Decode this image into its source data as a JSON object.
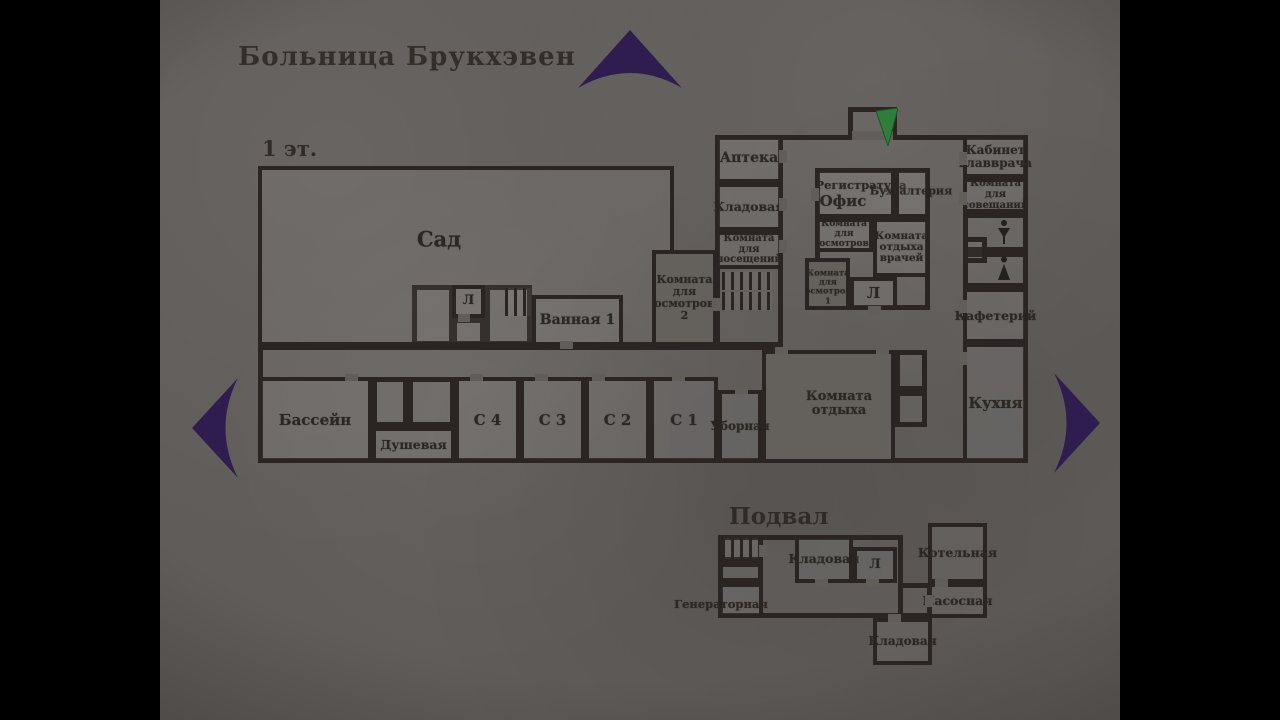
{
  "title": "Больница Брукхэвен",
  "colors": {
    "arrow_purple": "#301d4f",
    "arrow_green": "#2e7d3a",
    "wall": "#2a2522",
    "ink": "#2b2723",
    "paper": "#605c59"
  },
  "floor1": {
    "label": "1 эт.",
    "rooms": [
      {
        "name": "garden",
        "label": "Сад",
        "x": 258,
        "y": 166,
        "w": 416,
        "h": 180,
        "fs": 21,
        "lx": 435,
        "ly": 236
      },
      {
        "name": "elevator-1",
        "label": "Л",
        "x": 452,
        "y": 285,
        "w": 33,
        "h": 33,
        "fs": 13
      },
      {
        "name": "bathroom-1",
        "label": "Ванная 1",
        "x": 532,
        "y": 295,
        "w": 91,
        "h": 51,
        "fs": 14,
        "nw": true
      },
      {
        "name": "exam-room-2",
        "label": "Комната\nдля\nосмотров\n2",
        "x": 652,
        "y": 250,
        "w": 65,
        "h": 96,
        "fs": 11,
        "solid": true
      },
      {
        "name": "pharmacy",
        "label": "Аптека",
        "x": 715,
        "y": 135,
        "w": 68,
        "h": 48,
        "fs": 14
      },
      {
        "name": "storeroom-1f",
        "label": "Кладовая",
        "x": 715,
        "y": 183,
        "w": 68,
        "h": 48,
        "fs": 12.5
      },
      {
        "name": "visiting-room",
        "label": "Комната для\nпосещений",
        "x": 715,
        "y": 231,
        "w": 68,
        "h": 38,
        "fs": 10
      },
      {
        "name": "registration-office",
        "label": "Регистратура",
        "x": 815,
        "y": 168,
        "w": 80,
        "h": 50,
        "fs": 11.5,
        "lx": 857,
        "ly": 181
      },
      {
        "name": "accounting",
        "label": "",
        "x": 895,
        "y": 168,
        "w": 35,
        "h": 50,
        "fs": 11
      },
      {
        "name": "exam-room-mid",
        "label": "Комната\nдля\nосмотров",
        "x": 815,
        "y": 218,
        "w": 58,
        "h": 34,
        "fs": 9
      },
      {
        "name": "doctors-lounge",
        "label": "Комната\nотдыха\nврачей",
        "x": 873,
        "y": 218,
        "w": 57,
        "h": 59,
        "fs": 10.5
      },
      {
        "name": "exam-room-1",
        "label": "Комната\nдля\nосмотров\n1",
        "x": 805,
        "y": 258,
        "w": 45,
        "h": 52,
        "fs": 8.5,
        "lx": 824,
        "ly": 284,
        "solid": true
      },
      {
        "name": "elevator-2",
        "label": "Л",
        "x": 850,
        "y": 277,
        "w": 47,
        "h": 33,
        "fs": 15
      },
      {
        "name": "head-doctor-office",
        "label": "Кабинет\nглавврача",
        "x": 963,
        "y": 135,
        "w": 65,
        "h": 43,
        "fs": 12
      },
      {
        "name": "meeting-room",
        "label": "Комната для\nсовещаний",
        "x": 963,
        "y": 178,
        "w": 65,
        "h": 35,
        "fs": 10
      },
      {
        "name": "cafeteria",
        "label": "Кафетерий",
        "x": 963,
        "y": 288,
        "w": 65,
        "h": 55,
        "fs": 12.5,
        "nw": true
      },
      {
        "name": "kitchen",
        "label": "Кухня",
        "x": 963,
        "y": 343,
        "w": 65,
        "h": 120,
        "fs": 15
      },
      {
        "name": "lounge",
        "label": "Комната\nотдыха",
        "x": 762,
        "y": 350,
        "w": 133,
        "h": 113,
        "fs": 13,
        "lx": 835,
        "ly": 400,
        "solid": true
      },
      {
        "name": "pool",
        "label": "Бассейн",
        "x": 258,
        "y": 377,
        "w": 114,
        "h": 86,
        "fs": 15
      },
      {
        "name": "shower",
        "label": "Душевая",
        "x": 372,
        "y": 427,
        "w": 83,
        "h": 36,
        "fs": 12.5,
        "nw": true
      },
      {
        "name": "ward-c4",
        "label": "С 4",
        "x": 455,
        "y": 377,
        "w": 65,
        "h": 86,
        "fs": 15
      },
      {
        "name": "ward-c3",
        "label": "С 3",
        "x": 520,
        "y": 377,
        "w": 65,
        "h": 86,
        "fs": 15
      },
      {
        "name": "ward-c2",
        "label": "С 2",
        "x": 585,
        "y": 377,
        "w": 65,
        "h": 86,
        "fs": 15
      },
      {
        "name": "ward-c1",
        "label": "С 1",
        "x": 650,
        "y": 377,
        "w": 68,
        "h": 86,
        "fs": 15
      },
      {
        "name": "restroom",
        "label": "Уборная",
        "x": 718,
        "y": 390,
        "w": 44,
        "h": 73,
        "fs": 12,
        "nw": true
      }
    ],
    "blocks": [
      {
        "name": "south-strip",
        "x": 258,
        "y": 345,
        "w": 525,
        "h": 118,
        "noR": true
      },
      {
        "name": "north-wing",
        "x": 783,
        "y": 135,
        "w": 245,
        "h": 328,
        "noL": true
      },
      {
        "name": "west-column",
        "x": 715,
        "y": 135,
        "w": 68,
        "h": 212
      },
      {
        "name": "entrance-alcove",
        "x": 848,
        "y": 107,
        "w": 49,
        "h": 30
      },
      {
        "name": "room-by-lift",
        "x": 412,
        "y": 285,
        "w": 42,
        "h": 61
      },
      {
        "name": "lift-vestibule",
        "x": 452,
        "y": 318,
        "w": 33,
        "h": 28
      },
      {
        "name": "stairwell-garden",
        "x": 485,
        "y": 285,
        "w": 47,
        "h": 61
      },
      {
        "name": "central-island",
        "x": 815,
        "y": 168,
        "w": 115,
        "h": 142
      },
      {
        "name": "wc-room-1",
        "x": 963,
        "y": 213,
        "w": 65,
        "h": 39
      },
      {
        "name": "wc-room-2",
        "x": 963,
        "y": 252,
        "w": 65,
        "h": 36
      },
      {
        "name": "wc-niche",
        "x": 963,
        "y": 237,
        "w": 24,
        "h": 26
      },
      {
        "name": "closet-1",
        "x": 895,
        "y": 350,
        "w": 32,
        "h": 41
      },
      {
        "name": "closet-2",
        "x": 895,
        "y": 391,
        "w": 32,
        "h": 36
      },
      {
        "name": "shower-closet-1",
        "x": 372,
        "y": 377,
        "w": 36,
        "h": 50
      },
      {
        "name": "shower-closet-2",
        "x": 408,
        "y": 377,
        "w": 47,
        "h": 50
      }
    ],
    "stairs": [
      {
        "x": 505,
        "y": 288,
        "w": 26,
        "h": 28
      },
      {
        "x": 722,
        "y": 272,
        "w": 50,
        "h": 18
      },
      {
        "x": 722,
        "y": 292,
        "w": 50,
        "h": 18
      }
    ],
    "doors": [
      {
        "x": 345,
        "y": 374,
        "w": 13,
        "h": 7
      },
      {
        "x": 470,
        "y": 374,
        "w": 13,
        "h": 7
      },
      {
        "x": 535,
        "y": 374,
        "w": 13,
        "h": 7
      },
      {
        "x": 592,
        "y": 374,
        "w": 13,
        "h": 7
      },
      {
        "x": 672,
        "y": 374,
        "w": 13,
        "h": 7
      },
      {
        "x": 735,
        "y": 387,
        "w": 13,
        "h": 7
      },
      {
        "x": 775,
        "y": 347,
        "w": 13,
        "h": 7
      },
      {
        "x": 876,
        "y": 347,
        "w": 13,
        "h": 7
      },
      {
        "x": 779,
        "y": 150,
        "w": 8,
        "h": 13
      },
      {
        "x": 779,
        "y": 198,
        "w": 8,
        "h": 13
      },
      {
        "x": 779,
        "y": 240,
        "w": 8,
        "h": 13
      },
      {
        "x": 959,
        "y": 152,
        "w": 8,
        "h": 13
      },
      {
        "x": 959,
        "y": 192,
        "w": 8,
        "h": 13
      },
      {
        "x": 959,
        "y": 300,
        "w": 8,
        "h": 13
      },
      {
        "x": 959,
        "y": 352,
        "w": 8,
        "h": 13
      },
      {
        "x": 852,
        "y": 131,
        "w": 41,
        "h": 9
      },
      {
        "x": 811,
        "y": 188,
        "w": 8,
        "h": 13
      },
      {
        "x": 868,
        "y": 306,
        "w": 13,
        "h": 8
      },
      {
        "x": 712,
        "y": 298,
        "w": 8,
        "h": 13
      },
      {
        "x": 560,
        "y": 341,
        "w": 13,
        "h": 8
      },
      {
        "x": 458,
        "y": 314,
        "w": 12,
        "h": 8
      }
    ],
    "labels": [
      {
        "text": "Офис",
        "x": 843,
        "y": 201,
        "fs": 15
      },
      {
        "text": "Бухгалтерия",
        "x": 911,
        "y": 191,
        "fs": 11
      }
    ]
  },
  "basement": {
    "label": "Подвал",
    "rooms": [
      {
        "name": "generator-room",
        "label": "Генераторная",
        "x": 718,
        "y": 583,
        "w": 45,
        "h": 35,
        "fs": 11.5,
        "lx": 717,
        "ly": 600,
        "nw": true
      },
      {
        "name": "storeroom-b1",
        "label": "Кладовая",
        "x": 795,
        "y": 535,
        "w": 58,
        "h": 48,
        "fs": 12.5,
        "nw": true
      },
      {
        "name": "elevator-b",
        "label": "Л",
        "x": 853,
        "y": 547,
        "w": 44,
        "h": 36,
        "fs": 13
      },
      {
        "name": "boiler-room",
        "label": "Котельная",
        "x": 928,
        "y": 523,
        "w": 59,
        "h": 60,
        "fs": 12.5,
        "nw": true
      },
      {
        "name": "pump-room",
        "label": "Насосная",
        "x": 928,
        "y": 583,
        "w": 59,
        "h": 35,
        "fs": 12.5,
        "nw": true
      },
      {
        "name": "storeroom-b2",
        "label": "Кладовая",
        "x": 873,
        "y": 618,
        "w": 59,
        "h": 47,
        "fs": 12,
        "nw": true
      }
    ],
    "blocks": [
      {
        "name": "basement-hall",
        "x": 718,
        "y": 535,
        "w": 185,
        "h": 83
      },
      {
        "name": "basement-corridor",
        "x": 898,
        "y": 583,
        "w": 34,
        "h": 35
      },
      {
        "name": "basement-stair-room",
        "x": 718,
        "y": 535,
        "w": 45,
        "h": 27
      },
      {
        "name": "basement-understair",
        "x": 718,
        "y": 562,
        "w": 45,
        "h": 21
      }
    ],
    "stairs": [
      {
        "x": 722,
        "y": 538,
        "w": 38,
        "h": 21
      }
    ],
    "doors": [
      {
        "x": 759,
        "y": 545,
        "w": 8,
        "h": 12
      },
      {
        "x": 815,
        "y": 579,
        "w": 13,
        "h": 8
      },
      {
        "x": 866,
        "y": 579,
        "w": 13,
        "h": 8
      },
      {
        "x": 935,
        "y": 579,
        "w": 13,
        "h": 8
      },
      {
        "x": 925,
        "y": 595,
        "w": 8,
        "h": 12
      },
      {
        "x": 888,
        "y": 614,
        "w": 13,
        "h": 8
      }
    ],
    "labels": []
  },
  "icons": [
    {
      "name": "wc-female-icon"
    },
    {
      "name": "wc-male-icon"
    },
    {
      "name": "map-arrow-up"
    },
    {
      "name": "map-arrow-left"
    },
    {
      "name": "map-arrow-right"
    },
    {
      "name": "player-position-arrow"
    }
  ]
}
